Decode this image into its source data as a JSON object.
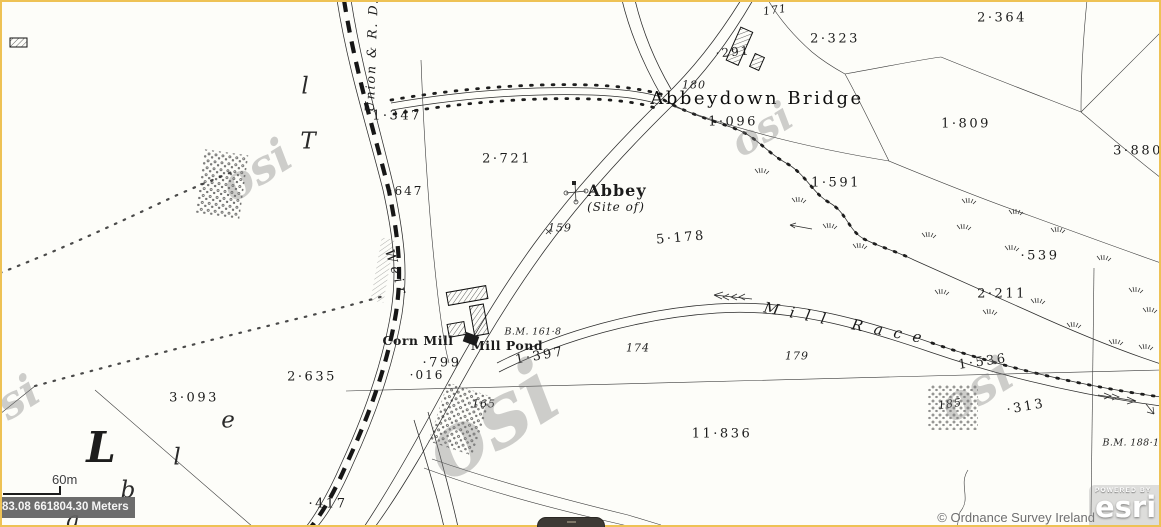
{
  "viewer": {
    "scalebar_label": "60m",
    "coordinates": "83.08 661804.30 Meters",
    "attribution": "© Ordnance Survey Ireland",
    "powered_by": "POWERED BY",
    "esri_logo": "esri",
    "colors": {
      "highlight_border": "#eec255",
      "coordinate_box_bg": "#606060",
      "attribution_text": "#6e6e6e",
      "map_ink": "#2b2b2b",
      "paper": "#fdfdf9"
    }
  },
  "map": {
    "labels": [
      {
        "text": "Union & R. D.",
        "x": 372,
        "y": 55,
        "cls": "boundary-name",
        "name": "boundary-label-union-rd",
        "rot": -88
      },
      {
        "text": "1·347",
        "x": 397,
        "y": 116,
        "cls": "parcel",
        "name": "parcel-1-347"
      },
      {
        "text": "·647",
        "x": 406,
        "y": 191,
        "cls": "parcel-sm",
        "name": "parcel-0-647"
      },
      {
        "text": "2·721",
        "x": 507,
        "y": 159,
        "cls": "parcel",
        "name": "parcel-2-721"
      },
      {
        "text": "Abbeydown Bridge",
        "x": 757,
        "y": 99,
        "cls": "place-lg",
        "name": "place-abbeydown-bridge"
      },
      {
        "text": "171",
        "x": 775,
        "y": 10,
        "cls": "spot",
        "name": "spot-height-171",
        "rot": -8
      },
      {
        "text": "·291",
        "x": 733,
        "y": 52,
        "cls": "parcel-sm",
        "name": "parcel-0-291",
        "rot": -5
      },
      {
        "text": "2·323",
        "x": 835,
        "y": 39,
        "cls": "parcel",
        "name": "parcel-2-323"
      },
      {
        "text": "2·364",
        "x": 1002,
        "y": 18,
        "cls": "parcel",
        "name": "parcel-2-364"
      },
      {
        "text": "1·809",
        "x": 966,
        "y": 124,
        "cls": "parcel",
        "name": "parcel-1-809"
      },
      {
        "text": "3·880",
        "x": 1138,
        "y": 151,
        "cls": "parcel",
        "name": "parcel-3-880"
      },
      {
        "text": "1·096",
        "x": 733,
        "y": 122,
        "cls": "parcel",
        "name": "parcel-1-096"
      },
      {
        "text": "180",
        "x": 694,
        "y": 85,
        "cls": "spot",
        "name": "spot-height-180"
      },
      {
        "text": "Abbey",
        "x": 617,
        "y": 191,
        "cls": "gothic-lg",
        "name": "place-abbey"
      },
      {
        "text": "(Site of)",
        "x": 616,
        "y": 207,
        "cls": "site-of",
        "name": "place-abbey-site-of"
      },
      {
        "text": "159",
        "x": 560,
        "y": 228,
        "cls": "spot",
        "name": "spot-height-159"
      },
      {
        "text": "5·178",
        "x": 681,
        "y": 238,
        "cls": "parcel",
        "name": "parcel-5-178",
        "rot": -5
      },
      {
        "text": "1·591",
        "x": 836,
        "y": 183,
        "cls": "parcel",
        "name": "parcel-1-591"
      },
      {
        "text": "·539",
        "x": 1040,
        "y": 256,
        "cls": "parcel",
        "name": "parcel-0-539"
      },
      {
        "text": "2·211",
        "x": 1002,
        "y": 294,
        "cls": "parcel",
        "name": "parcel-2-211"
      },
      {
        "text": "Weir",
        "x": 396,
        "y": 274,
        "cls": "water-vert",
        "name": "place-weir",
        "rot": 72
      },
      {
        "text": "Corn Mill",
        "x": 418,
        "y": 341,
        "cls": "gothic-sm",
        "name": "place-corn-mill"
      },
      {
        "text": "Mill Pond",
        "x": 507,
        "y": 346,
        "cls": "gothic-sm",
        "name": "place-mill-pond"
      },
      {
        "text": "B.M. 161·8",
        "x": 533,
        "y": 332,
        "cls": "bm",
        "name": "benchmark-161-8"
      },
      {
        "text": "·799",
        "x": 442,
        "y": 363,
        "cls": "parcel",
        "name": "parcel-0-799"
      },
      {
        "text": "·016",
        "x": 427,
        "y": 375,
        "cls": "parcel-sm",
        "name": "parcel-0-016"
      },
      {
        "text": "1·397",
        "x": 540,
        "y": 356,
        "cls": "parcel",
        "name": "parcel-1-397",
        "rot": -10
      },
      {
        "text": "174",
        "x": 638,
        "y": 348,
        "cls": "spot",
        "name": "spot-height-174"
      },
      {
        "text": "179",
        "x": 797,
        "y": 356,
        "cls": "spot",
        "name": "spot-height-179"
      },
      {
        "text": "165",
        "x": 484,
        "y": 404,
        "cls": "spot",
        "name": "spot-height-165"
      },
      {
        "text": "Mill Race",
        "x": 848,
        "y": 324,
        "cls": "water",
        "name": "place-mill-race",
        "rot": 11
      },
      {
        "text": "2·635",
        "x": 312,
        "y": 377,
        "cls": "parcel",
        "name": "parcel-2-635"
      },
      {
        "text": "3·093",
        "x": 194,
        "y": 398,
        "cls": "parcel",
        "name": "parcel-3-093"
      },
      {
        "text": "11·836",
        "x": 722,
        "y": 434,
        "cls": "parcel",
        "name": "parcel-11-836"
      },
      {
        "text": "1·536",
        "x": 983,
        "y": 362,
        "cls": "parcel",
        "name": "parcel-1-536",
        "rot": -8
      },
      {
        "text": "·313",
        "x": 1026,
        "y": 407,
        "cls": "parcel",
        "name": "parcel-0-313",
        "rot": -10
      },
      {
        "text": "185",
        "x": 950,
        "y": 404,
        "cls": "spot",
        "name": "spot-height-185",
        "rot": -8
      },
      {
        "text": "B.M. 188·1",
        "x": 1131,
        "y": 443,
        "cls": "bm",
        "name": "benchmark-188-1"
      },
      {
        "text": "·417",
        "x": 328,
        "y": 504,
        "cls": "parcel",
        "name": "parcel-0-417"
      },
      {
        "text": "L",
        "x": 101,
        "y": 448,
        "cls": "letter-lg",
        "name": "townland-initial-letter"
      },
      {
        "text": "e",
        "x": 228,
        "y": 421,
        "cls": "letter",
        "name": "townland-letter"
      },
      {
        "text": "l",
        "x": 177,
        "y": 458,
        "cls": "letter",
        "name": "townland-letter"
      },
      {
        "text": "b",
        "x": 128,
        "y": 491,
        "cls": "letter",
        "name": "townland-letter"
      },
      {
        "text": "a",
        "x": 73,
        "y": 521,
        "cls": "letter",
        "name": "townland-letter"
      },
      {
        "text": "l",
        "x": 305,
        "y": 87,
        "cls": "letter",
        "name": "townland-letter"
      },
      {
        "text": "T",
        "x": 308,
        "y": 142,
        "cls": "letter",
        "name": "townland-letter"
      },
      {
        "text": "osi",
        "x": 256,
        "y": 170,
        "cls": "wm",
        "name": "osi-watermark",
        "rot": -32,
        "fz": 46
      },
      {
        "text": "osi",
        "x": 490,
        "y": 420,
        "cls": "wm",
        "name": "osi-watermark",
        "rot": -32,
        "fz": 88
      },
      {
        "text": "osi",
        "x": 762,
        "y": 130,
        "cls": "wm",
        "name": "osi-watermark",
        "rot": -32,
        "fz": 40
      },
      {
        "text": "osi",
        "x": 976,
        "y": 390,
        "cls": "wm",
        "name": "osi-watermark",
        "rot": -32,
        "fz": 48
      },
      {
        "text": "osi",
        "x": 6,
        "y": 406,
        "cls": "wm",
        "name": "osi-watermark",
        "rot": -32,
        "fz": 44
      }
    ]
  }
}
